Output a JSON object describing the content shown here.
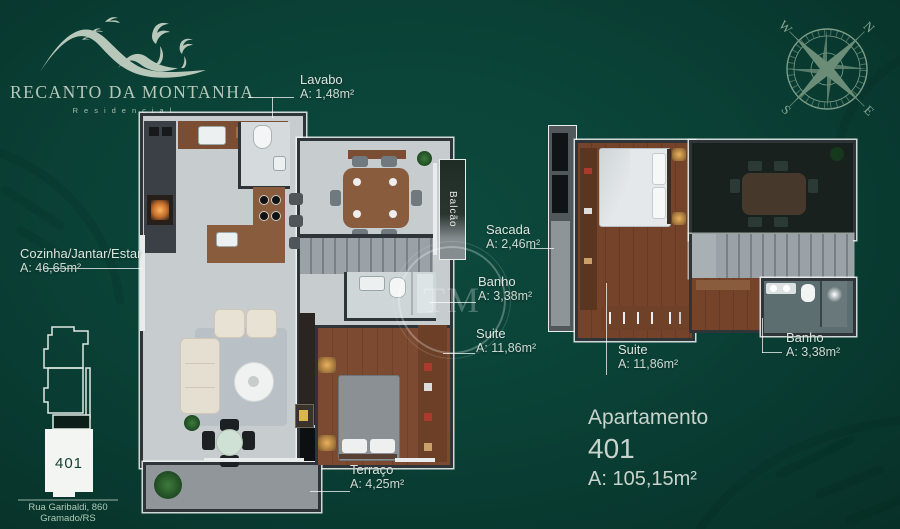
{
  "brand": {
    "name": "RECANTO DA MONTANHA",
    "subtitle": "Residencial"
  },
  "compass": {
    "n": "N",
    "e": "E",
    "s": "S",
    "w": "W"
  },
  "watermark_text": "TM",
  "plan_left": {
    "balcony_label": "Balcão",
    "rooms": {
      "lavabo": {
        "name": "Lavabo",
        "area": "A: 1,48m²"
      },
      "cozinha_jantar_estar": {
        "name": "Cozinha/Jantar/Estar",
        "area": "A: 46,65m²"
      },
      "banho": {
        "name": "Banho",
        "area": "A: 3,38m²"
      },
      "suite": {
        "name": "Suite",
        "area": "A: 11,86m²"
      },
      "terraco": {
        "name": "Terraço",
        "area": "A: 4,25m²"
      }
    }
  },
  "plan_right": {
    "rooms": {
      "sacada": {
        "name": "Sacada",
        "area": "A: 2,46m²"
      },
      "suite": {
        "name": "Suite",
        "area": "A: 11,86m²"
      },
      "banho": {
        "name": "Banho",
        "area": "A: 3,38m²"
      }
    }
  },
  "apartment": {
    "label": "Apartamento",
    "number": "401",
    "area": "A: 105,15m²"
  },
  "location": {
    "unit": "401",
    "address_line1": "Rua Garibaldi, 860",
    "address_line2": "Gramado/RS"
  },
  "colors": {
    "background": "#0a4136",
    "text": "#dce4de",
    "logo": "#b7c8ba",
    "wood": "#7c4a30",
    "wall": "#2f3438",
    "accent_white": "#f2f5f2"
  }
}
